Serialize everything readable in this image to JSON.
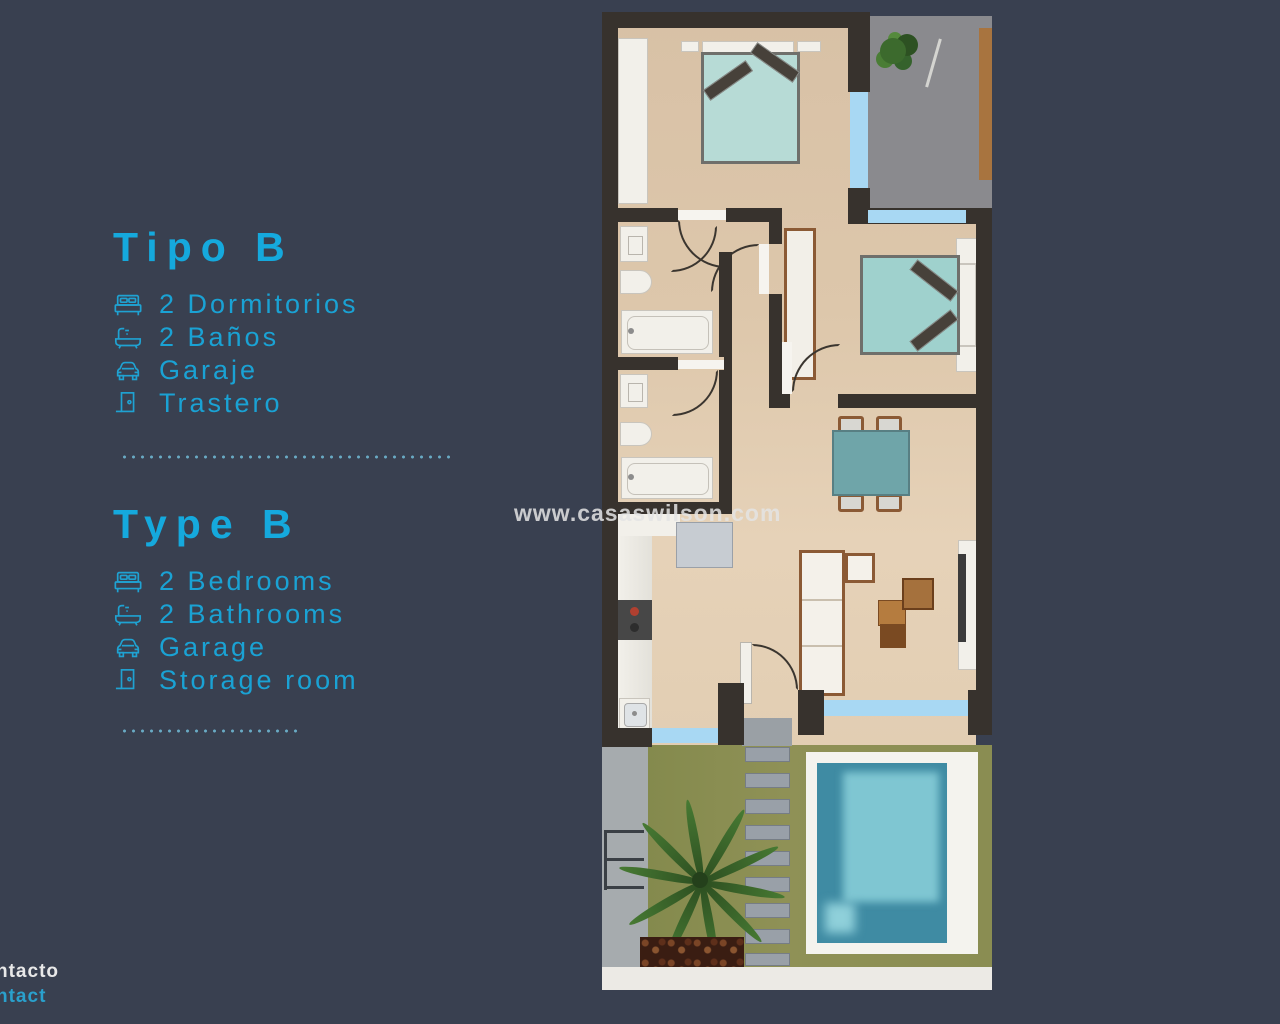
{
  "page": {
    "watermark": "www.casaswilson.com",
    "colors": {
      "background": "#394050",
      "accent_cyan": "#17a6d8",
      "wall_dark": "#37322d",
      "floor_beige": "#ddc7ab",
      "window_blue": "#a8d8f3",
      "bed_teal": "#a9d5d1",
      "pool_teal": "#4aa4ba",
      "lawn_green": "#8d9054",
      "terrace_gray": "#8a8a8e",
      "footer_white": "#e8e8e8"
    }
  },
  "es": {
    "title": "Tipo B",
    "items": [
      {
        "icon": "bed-icon",
        "label": "2 Dormitorios"
      },
      {
        "icon": "bath-icon",
        "label": "2 Baños"
      },
      {
        "icon": "car-icon",
        "label": "Garaje"
      },
      {
        "icon": "door-icon",
        "label": "Trastero"
      }
    ]
  },
  "en": {
    "title": "Type B",
    "items": [
      {
        "icon": "bed-icon",
        "label": "2 Bedrooms"
      },
      {
        "icon": "bath-icon",
        "label": "2 Bathrooms"
      },
      {
        "icon": "car-icon",
        "label": "Garage"
      },
      {
        "icon": "door-icon",
        "label": "Storage  room"
      }
    ]
  },
  "footer": {
    "line1": "ntacto",
    "line2": "ntact"
  }
}
